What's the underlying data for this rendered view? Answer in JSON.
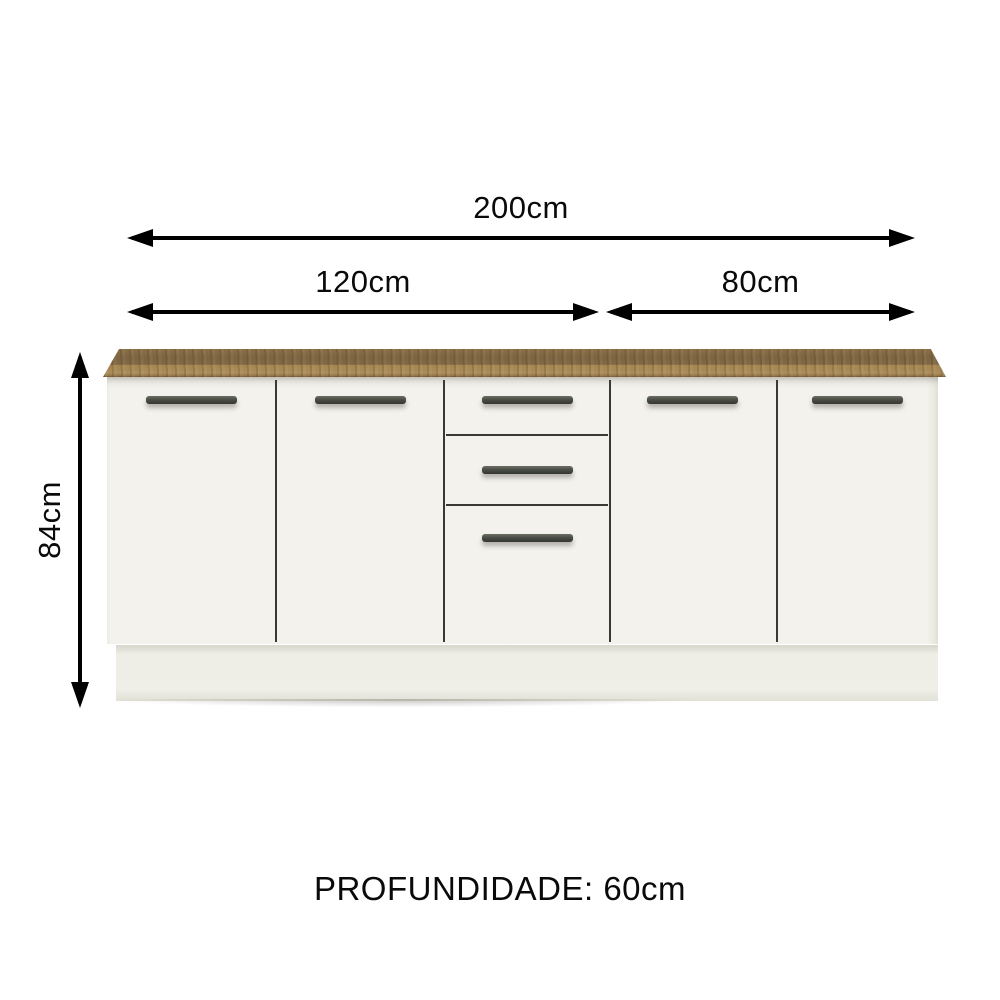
{
  "dimensions": {
    "total_width_label": "200cm",
    "left_section_label": "120cm",
    "right_section_label": "80cm",
    "height_label": "84cm",
    "depth_label": "PROFUNDIDADE: 60cm"
  },
  "cabinet": {
    "door_count": 4,
    "drawer_count": 3,
    "colors": {
      "countertop_wood_dark": "#7d6441",
      "countertop_edge_tan": "#ab8c5b",
      "countertop_bottom_lip": "#64492b",
      "body_white": "#f3f2ec",
      "plinth_white": "#efeee7",
      "handle_dark": "#4a4e45",
      "divider_line": "#3a3a34",
      "dimension_ink": "#000000",
      "background": "#ffffff"
    }
  }
}
